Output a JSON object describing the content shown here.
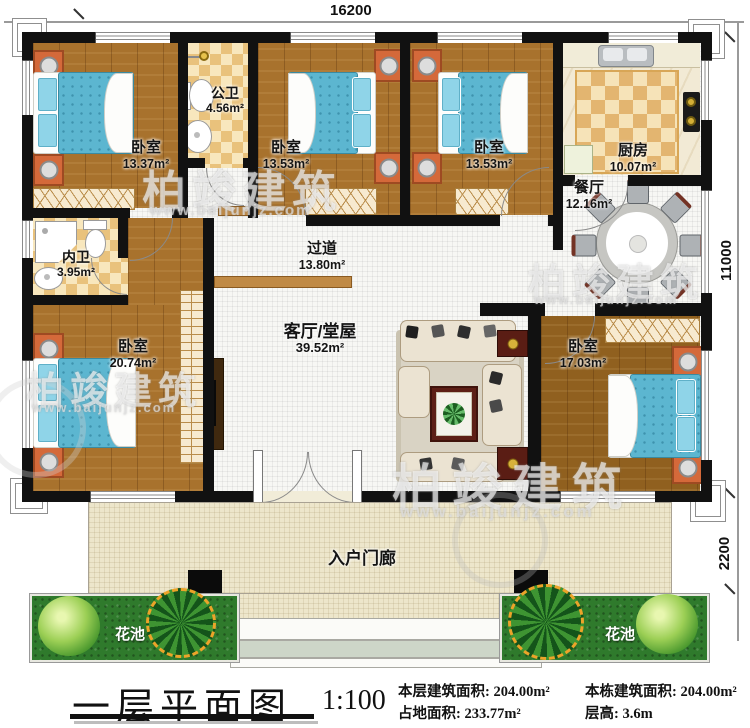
{
  "dimensions": {
    "top": "16200",
    "right_upper": "11000",
    "right_lower": "2200"
  },
  "rooms": {
    "bedroom_tl": {
      "name": "卧室",
      "area": "13.37m²"
    },
    "public_bath": {
      "name": "公卫",
      "area": "4.56m²"
    },
    "bedroom_tm": {
      "name": "卧室",
      "area": "13.53m²"
    },
    "bedroom_tr": {
      "name": "卧室",
      "area": "13.53m²"
    },
    "kitchen": {
      "name": "厨房",
      "area": "10.07m²"
    },
    "dining": {
      "name": "餐厅",
      "area": "12.16m²"
    },
    "ensuite_bath": {
      "name": "内卫",
      "area": "3.95m²"
    },
    "bedroom_left": {
      "name": "卧室",
      "area": "20.74m²"
    },
    "hallway": {
      "name": "过道",
      "area": "13.80m²"
    },
    "living": {
      "name": "客厅/堂屋",
      "area": "39.52m²"
    },
    "bedroom_right": {
      "name": "卧室",
      "area": "17.03m²"
    },
    "porch": {
      "name": "入户门廊"
    },
    "flowerbed_left": {
      "name": "花池"
    },
    "flowerbed_right": {
      "name": "花池"
    }
  },
  "legend": {
    "title": "一层平面图",
    "scale": "1:100",
    "stats_col1": [
      {
        "label": "本层建筑面积:",
        "value": "204.00m²"
      },
      {
        "label": "占地面积:",
        "value": "233.77m²"
      }
    ],
    "stats_col2": [
      {
        "label": "本栋建筑面积:",
        "value": "204.00m²"
      },
      {
        "label": "层高:",
        "value": "3.6m"
      }
    ]
  },
  "watermark": {
    "brand": "柏竣建筑",
    "url": "www.baijunjz.com"
  },
  "colors": {
    "wall": "#111111",
    "wood": "#a8722d",
    "tile": "#e9c27c",
    "bed": "#5cb6d0",
    "garden": "#2f7a2c"
  }
}
